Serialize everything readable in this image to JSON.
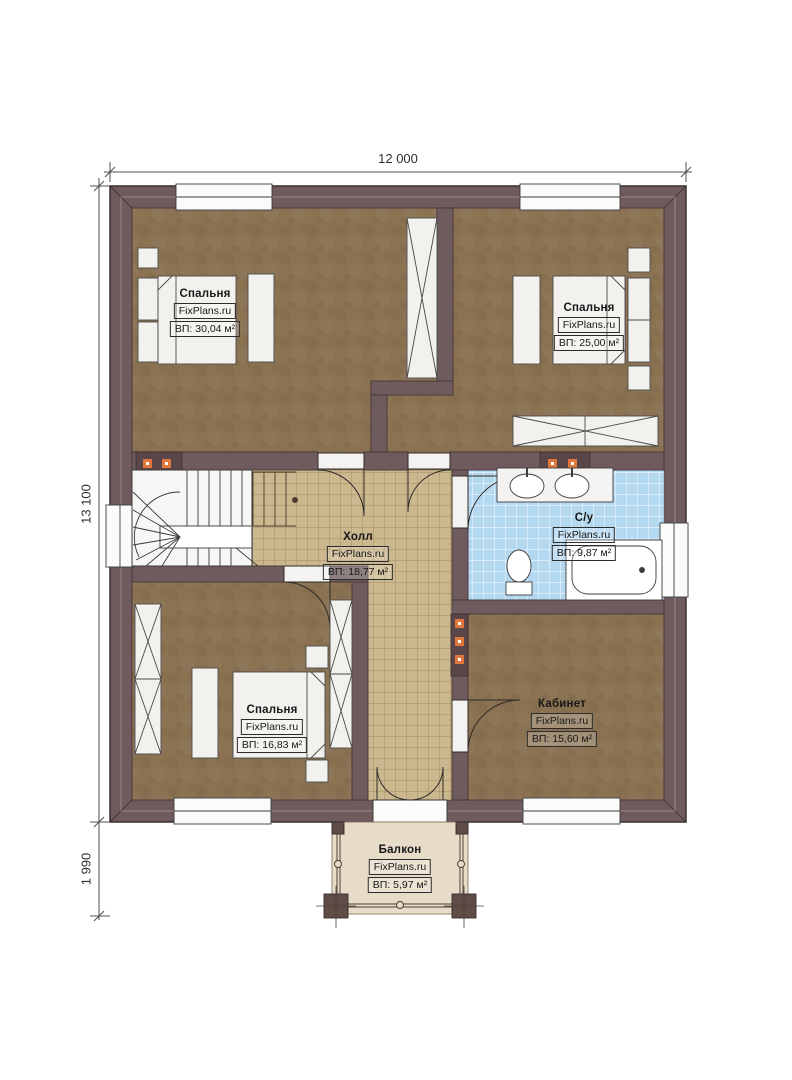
{
  "plan": {
    "type": "floor-plan",
    "watermark": "FixPlans.ru"
  },
  "dimensions": {
    "width_total": "12 000",
    "height_total": "13 100",
    "balcony_depth": "1 990"
  },
  "rooms": [
    {
      "key": "bedroom-top-left",
      "name": "Спальня",
      "brand": "FixPlans.ru",
      "area": "ВП: 30,04 м²"
    },
    {
      "key": "bedroom-top-right",
      "name": "Спальня",
      "brand": "FixPlans.ru",
      "area": "ВП: 25,00 м²"
    },
    {
      "key": "hall",
      "name": "Холл",
      "brand": "FixPlans.ru",
      "area": "ВП: 18,77 м²"
    },
    {
      "key": "bathroom",
      "name": "С/у",
      "brand": "FixPlans.ru",
      "area": "ВП: 9,87 м²"
    },
    {
      "key": "bedroom-bottom-left",
      "name": "Спальня",
      "brand": "FixPlans.ru",
      "area": "ВП: 16,83 м²"
    },
    {
      "key": "office",
      "name": "Кабинет",
      "brand": "FixPlans.ru",
      "area": "ВП: 15,60 м²"
    },
    {
      "key": "balcony",
      "name": "Балкон",
      "brand": "FixPlans.ru",
      "area": "ВП: 5,97 м²"
    }
  ],
  "colors": {
    "wall": "#6f5b5d",
    "wall_outline": "#3c3031",
    "floor_wood": "#8a7252",
    "tile_hall": "#ccb88e",
    "tile_bath": "#b5d8f1",
    "balcony_floor": "#e6dcc8",
    "furniture": "#f2f1ee",
    "radiator_accent": "#e0773c"
  }
}
